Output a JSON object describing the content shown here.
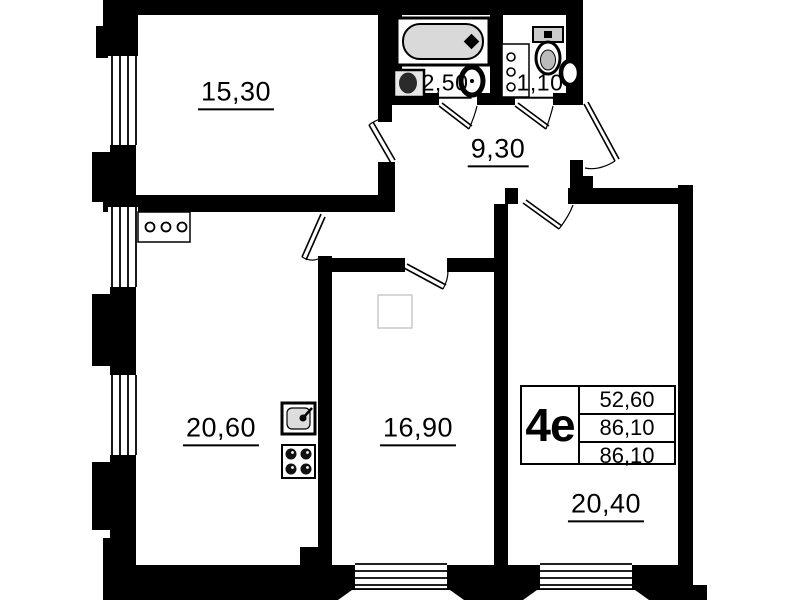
{
  "floor_plan": {
    "rooms": [
      {
        "name": "room-top-left",
        "area_label": "15,30"
      },
      {
        "name": "bathroom",
        "area_label": "2,50"
      },
      {
        "name": "wc",
        "area_label": "1,10"
      },
      {
        "name": "hallway",
        "area_label": "9,30"
      },
      {
        "name": "kitchen-living",
        "area_label": "20,60"
      },
      {
        "name": "room-middle",
        "area_label": "16,90"
      },
      {
        "name": "room-right",
        "area_label": "20,40"
      }
    ],
    "info_table": {
      "apartment_type": "4е",
      "values": [
        "52,60",
        "86,10",
        "86,10"
      ]
    },
    "fixtures": [
      "bathtub-icon",
      "washbasin-icon",
      "toilet-icon",
      "wc-sink-icon",
      "riser-pipes-icon",
      "vent-panel-icon",
      "kitchen-sink-icon",
      "stove-icon"
    ],
    "colors": {
      "walls": "#000000",
      "background": "#ffffff",
      "fixture_fill": "#d9d9d9",
      "ghost_outline": "#c9c9c9"
    }
  }
}
